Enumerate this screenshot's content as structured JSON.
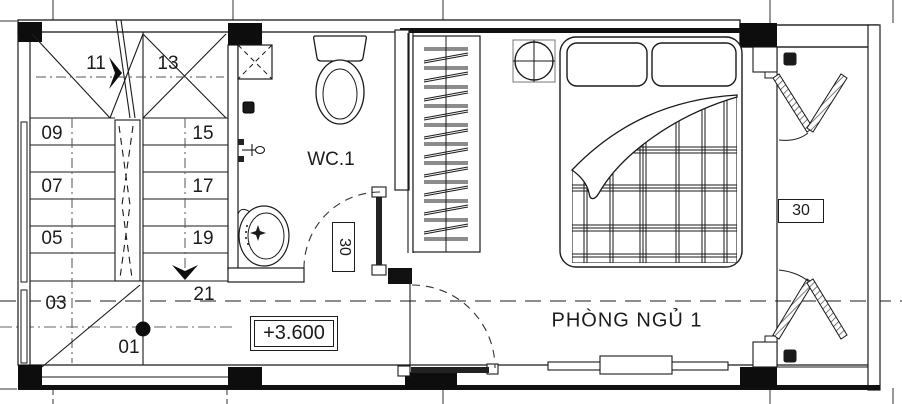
{
  "stair": {
    "steps": [
      "11",
      "13",
      "09",
      "15",
      "07",
      "17",
      "05",
      "19",
      "03",
      "21",
      "01"
    ]
  },
  "wc": {
    "name": "WC.1",
    "door_width": "30"
  },
  "bedroom": {
    "name": "PHÒNG NGỦ 1"
  },
  "balcony": {
    "door_width": "30"
  },
  "level": {
    "value": "+3.600"
  },
  "colors": {
    "line": "#1a1a1a",
    "solid_fill": "#0d0d0d",
    "grid": "#666666"
  }
}
